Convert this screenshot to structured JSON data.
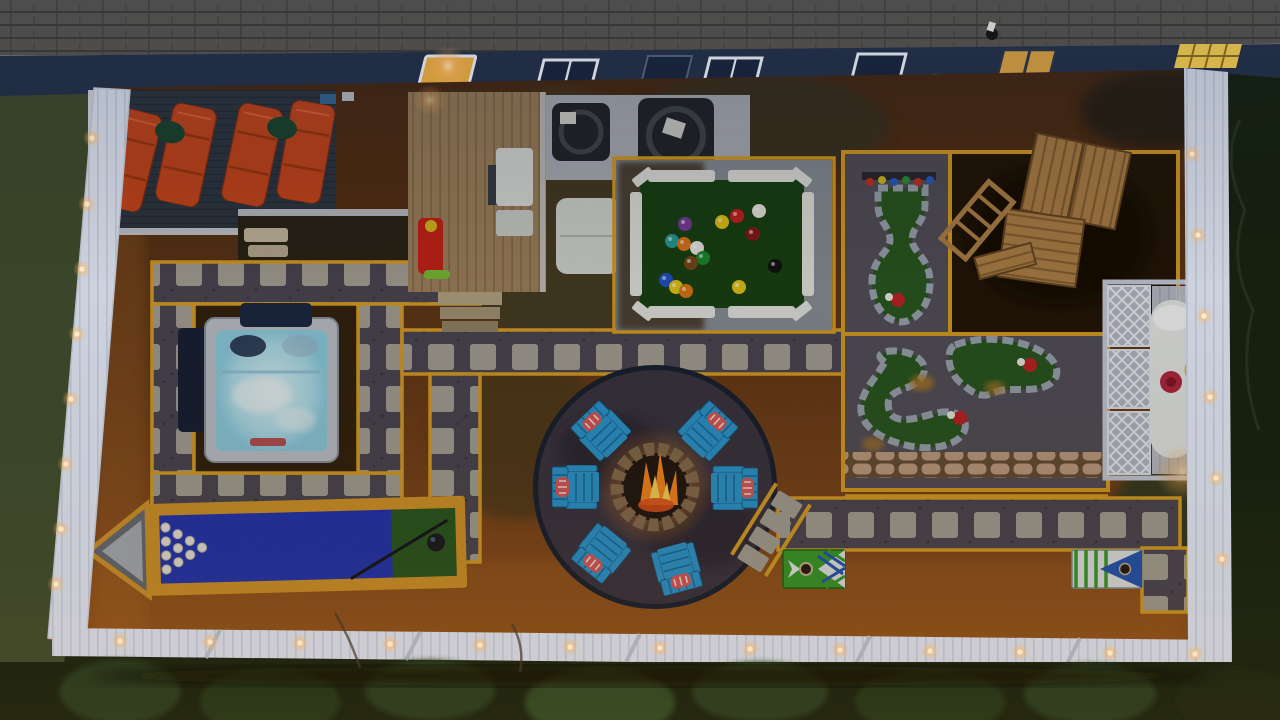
{
  "scene": {
    "type": "aerial-backyard-photo",
    "time_of_day": "dusk",
    "amenities": [
      "lounge-deck",
      "chaise-lounges",
      "grill-deck",
      "gas-grill",
      "kids-slide",
      "ac-units",
      "deck-box",
      "giant-pool-table",
      "mini-golf-course",
      "playground-structure",
      "propane-tank-enclosure",
      "hot-tub",
      "fire-pit",
      "adirondack-chairs",
      "bowling-lane",
      "cornhole-boards",
      "paver-paths",
      "string-lights",
      "white-fence"
    ],
    "counts": {
      "chaise_lounges": 4,
      "fire_pit_chairs": 6,
      "bowling_pins": 10,
      "pool_balls": 15,
      "mini_golf_greens": 3,
      "cornhole_boards": 2,
      "ac_units": 2
    }
  },
  "pool_table": {
    "balls": [
      {
        "x": 737,
        "y": 216,
        "color": "#cc2222"
      },
      {
        "x": 759,
        "y": 211,
        "color": "#f0ede6"
      },
      {
        "x": 722,
        "y": 222,
        "color": "#e6c817"
      },
      {
        "x": 685,
        "y": 224,
        "color": "#7a3fa0"
      },
      {
        "x": 753,
        "y": 234,
        "color": "#8e1a1a"
      },
      {
        "x": 775,
        "y": 266,
        "color": "#141414"
      },
      {
        "x": 672,
        "y": 241,
        "color": "#2aa198"
      },
      {
        "x": 684,
        "y": 244,
        "color": "#e07818"
      },
      {
        "x": 697,
        "y": 248,
        "color": "#f0ede6"
      },
      {
        "x": 703,
        "y": 258,
        "color": "#1c8c32"
      },
      {
        "x": 691,
        "y": 263,
        "color": "#7a4a1a"
      },
      {
        "x": 666,
        "y": 280,
        "color": "#2255cc"
      },
      {
        "x": 676,
        "y": 287,
        "color": "#e6c817"
      },
      {
        "x": 686,
        "y": 291,
        "color": "#e07818"
      },
      {
        "x": 739,
        "y": 287,
        "color": "#e6c817"
      }
    ]
  },
  "colors": {
    "roof": "#56524b",
    "roof_line": "#3d3a35",
    "siding": "#222e44",
    "window_frame": "#e8ecf2",
    "window_glass": "#18233a",
    "window_lit": "#f5b13d",
    "deck_dark": "#303945",
    "deck_line": "#252e3a",
    "lounger": "#d04a1e",
    "pillow_green": "#1d4a33",
    "rail_white": "#d9dee8",
    "wood_deck": "#a3855f",
    "wood_line": "#876b4a",
    "grill": "#e3e5e2",
    "toy_red": "#cc2418",
    "toy_yellow": "#e0c020",
    "gravel_light": "#b3b7bf",
    "ac_unit": "#23272b",
    "deck_box": "#d9dbd5",
    "pad_gravel": "#8d939b",
    "turf_dark": "#1a4414",
    "table_rail": "#e9e9e4",
    "path_gravel": "#4e4a54",
    "paver": "#aaa69a",
    "path_yellow": "#dfa224",
    "mulch": "#5d3517",
    "mulch_deep": "#47280f",
    "mulch_lit": "#a8631f",
    "grass_olive": "#473f28",
    "grass_dark": "#333a20",
    "firepit_patio": "#3d3642",
    "firepit_rim": "#1b2232",
    "firering_stone": "#8a7050",
    "fire_orange": "#ff8a1c",
    "fire_yellow": "#ffd95e",
    "chair_blue": "#2d9bd4",
    "chair_blue_dark": "#1b6f9e",
    "chair_pillow": "#e05b5b",
    "spa_shell": "#c3c8d0",
    "spa_water": "#bfe9f4",
    "spa_cover": "#1d2a46",
    "bowl_frame": "#d9992b",
    "bowl_lane": "#2336b4",
    "bowl_green": "#2c5a21",
    "pin_white": "#efeae2",
    "bowl_ball": "#1c1c22",
    "golf_green": "#2c5a21",
    "golf_gravel": "#57525c",
    "golf_stone": "#9fa8b4",
    "flag_red": "#c32424",
    "stone_wall": "#c5a184",
    "mulch_dark": "#241708",
    "play_wood": "#b5854a",
    "play_wood_dark": "#8a6132",
    "fence_white": "#ccd2de",
    "fence_shadow": "#9aa2b4",
    "light_warm": "#ffd9a0",
    "glow_amber": "#ffb45e",
    "lattice_base": "#b9bfcc",
    "tank_white": "#eef0ee",
    "tank_valve": "#b8293f",
    "hose_yellow": "#d8c428",
    "tree_dark": "#15200f",
    "shrub_green": "#23381a",
    "grass_out": "#3a4629",
    "corn_green": "#3aa02a",
    "corn_white": "#e8ecee",
    "corn_blue": "#2458b8"
  }
}
